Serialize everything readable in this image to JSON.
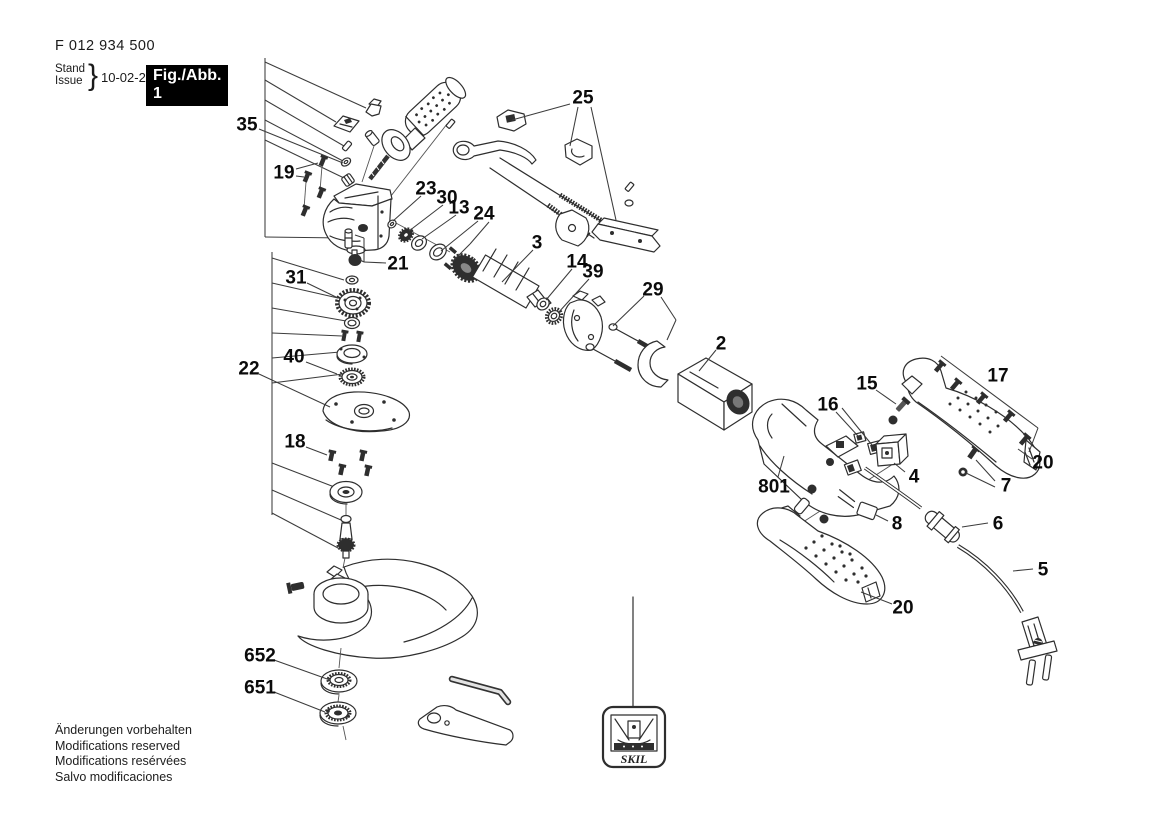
{
  "header": {
    "part_number": "F 012 934 500",
    "stand_label": "Stand",
    "issue_label": "Issue",
    "brace": "}",
    "date": "10-02-24",
    "figure_label": "Fig./Abb. 1"
  },
  "footer": {
    "lines": [
      "Änderungen vorbehalten",
      "Modifications reserved",
      "Modifications resérvées",
      "Salvo modificaciones"
    ]
  },
  "tag": {
    "brand": "SKIL"
  },
  "diagram": {
    "description": "Exploded parts drawing of angle grinder F 012 934 500",
    "callouts": [
      {
        "label": "35",
        "x": 247,
        "y": 124,
        "leaders": [
          [
            259,
            129,
            343,
            163
          ]
        ]
      },
      {
        "label": "19",
        "x": 284,
        "y": 172,
        "leaders": [
          [
            296,
            176,
            304,
            177
          ],
          [
            296,
            169,
            318,
            163
          ]
        ]
      },
      {
        "label": "25",
        "x": 583,
        "y": 97,
        "leaders": [
          [
            570,
            104,
            512,
            120
          ],
          [
            578,
            107,
            570,
            146
          ],
          [
            591,
            107,
            616,
            220
          ]
        ]
      },
      {
        "label": "23",
        "x": 426,
        "y": 188,
        "leaders": [
          [
            421,
            196,
            393,
            221
          ]
        ]
      },
      {
        "label": "30",
        "x": 447,
        "y": 197,
        "leaders": [
          [
            443,
            205,
            409,
            231
          ]
        ]
      },
      {
        "label": "13",
        "x": 459,
        "y": 207,
        "leaders": [
          [
            456,
            215,
            422,
            239
          ]
        ]
      },
      {
        "label": "24",
        "x": 484,
        "y": 213,
        "leaders": [
          [
            478,
            221,
            441,
            251
          ],
          [
            489,
            222,
            470,
            244
          ],
          [
            470,
            244,
            453,
            261
          ]
        ]
      },
      {
        "label": "3",
        "x": 537,
        "y": 242,
        "leaders": [
          [
            533,
            250,
            502,
            282
          ]
        ]
      },
      {
        "label": "14",
        "x": 577,
        "y": 261,
        "leaders": [
          [
            572,
            269,
            546,
            300
          ]
        ]
      },
      {
        "label": "39",
        "x": 593,
        "y": 271,
        "leaders": [
          [
            589,
            279,
            558,
            313
          ]
        ]
      },
      {
        "label": "29",
        "x": 653,
        "y": 289,
        "leaders": [
          [
            644,
            296,
            613,
            326
          ],
          [
            661,
            297,
            676,
            320
          ],
          [
            676,
            320,
            667,
            340
          ]
        ]
      },
      {
        "label": "2",
        "x": 721,
        "y": 343,
        "leaders": [
          [
            716,
            350,
            699,
            371
          ]
        ]
      },
      {
        "label": "21",
        "x": 398,
        "y": 263,
        "leaders": [
          [
            386,
            263,
            364,
            262
          ],
          [
            364,
            262,
            364,
            238
          ],
          [
            364,
            238,
            355,
            235
          ],
          [
            364,
            262,
            360,
            260
          ]
        ]
      },
      {
        "label": "31",
        "x": 296,
        "y": 277,
        "leaders": [
          [
            307,
            283,
            338,
            298
          ]
        ]
      },
      {
        "label": "40",
        "x": 294,
        "y": 356,
        "leaders": [
          [
            306,
            362,
            337,
            374
          ]
        ]
      },
      {
        "label": "22",
        "x": 249,
        "y": 368,
        "leaders": [
          [
            259,
            374,
            330,
            407
          ]
        ]
      },
      {
        "label": "18",
        "x": 295,
        "y": 441,
        "leaders": [
          [
            306,
            447,
            327,
            455
          ]
        ]
      },
      {
        "label": "15",
        "x": 867,
        "y": 383,
        "leaders": [
          [
            876,
            390,
            896,
            404
          ]
        ]
      },
      {
        "label": "16",
        "x": 828,
        "y": 404,
        "leaders": [
          [
            836,
            412,
            858,
            436
          ],
          [
            842,
            408,
            872,
            445
          ]
        ]
      },
      {
        "label": "17",
        "x": 998,
        "y": 375,
        "leaders": [
          [
            941,
            356,
            1038,
            428
          ],
          [
            1038,
            428,
            1029,
            452
          ]
        ]
      },
      {
        "label": "20",
        "x": 1043,
        "y": 462,
        "leaders": [
          [
            1032,
            459,
            1018,
            449
          ]
        ]
      },
      {
        "label": "801",
        "x": 774,
        "y": 486,
        "leaders": [
          [
            778,
            477,
            784,
            456
          ]
        ]
      },
      {
        "label": "4",
        "x": 914,
        "y": 476,
        "leaders": [
          [
            905,
            472,
            894,
            463
          ]
        ]
      },
      {
        "label": "7",
        "x": 1006,
        "y": 485,
        "leaders": [
          [
            995,
            481,
            976,
            460
          ],
          [
            995,
            487,
            966,
            473
          ]
        ]
      },
      {
        "label": "8",
        "x": 897,
        "y": 523,
        "leaders": [
          [
            888,
            521,
            876,
            515
          ]
        ]
      },
      {
        "label": "6",
        "x": 998,
        "y": 523,
        "leaders": [
          [
            988,
            523,
            962,
            527
          ]
        ]
      },
      {
        "label": "5",
        "x": 1043,
        "y": 569,
        "leaders": [
          [
            1033,
            569,
            1013,
            571
          ]
        ]
      },
      {
        "label": "20",
        "x": 903,
        "y": 607,
        "leaders": [
          [
            892,
            604,
            861,
            592
          ]
        ]
      },
      {
        "label": "652",
        "x": 260,
        "y": 655,
        "leaders": [
          [
            274,
            660,
            330,
            680
          ]
        ]
      },
      {
        "label": "651",
        "x": 260,
        "y": 687,
        "leaders": [
          [
            274,
            692,
            325,
            712
          ]
        ]
      }
    ]
  }
}
